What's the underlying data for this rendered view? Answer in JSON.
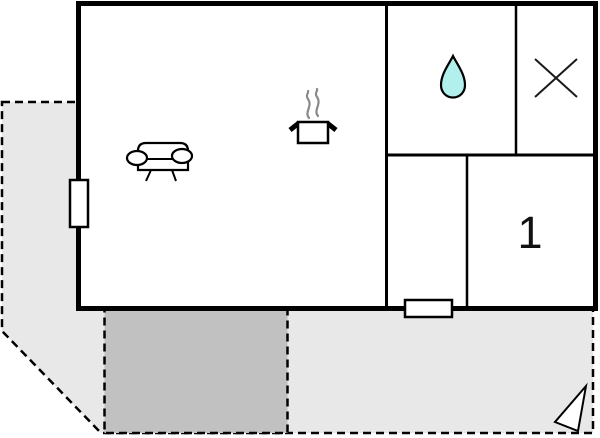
{
  "page": {
    "title": "Floor plan",
    "width": 600,
    "height": 438
  },
  "colors": {
    "wall": "#000000",
    "room_fill": "#ffffff",
    "terrace_light": "#e8e8e8",
    "terrace_dark": "#c1c1c1",
    "water_drop_fill": "#b2f0ee",
    "steam_stroke": "#8a8a8a",
    "symbol_stroke": "#1a1a1a"
  },
  "rooms": {
    "living_kitchen": {
      "icons": [
        "sofa-icon",
        "stove-pot-icon"
      ]
    },
    "bathroom": {
      "icons": [
        "water-drop-icon"
      ]
    },
    "side_room": {
      "icons": [
        "x-mark-icon"
      ]
    },
    "bedroom1": {
      "label": "1"
    }
  },
  "outdoor": {
    "areas": [
      "terrace-light",
      "patio-dark"
    ],
    "marker": "corner-triangle-marker"
  },
  "fixtures": [
    "window-left",
    "window-bottom"
  ]
}
